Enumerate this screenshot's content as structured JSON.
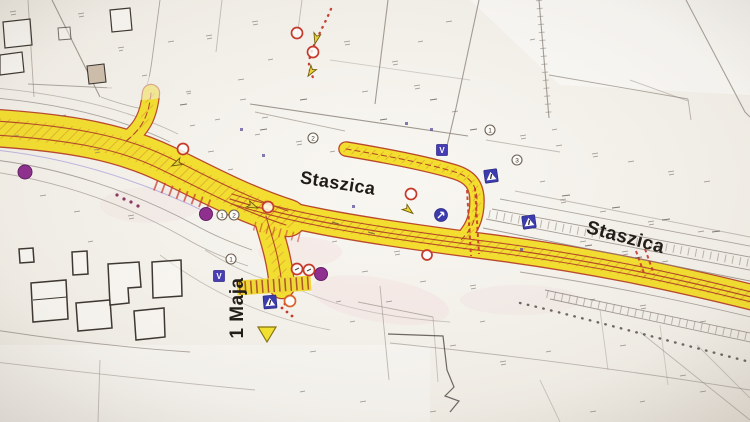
{
  "map": {
    "kind": "road-construction-plan-photo",
    "visible_street_names": [
      "Staszica",
      "Staszica",
      "1 Maja"
    ]
  },
  "labels": {
    "staszica_upper": "Staszica",
    "staszica_right": "Staszica",
    "maja": "1 Maja"
  },
  "markers": {
    "ref_circles": [
      {
        "label": "1"
      },
      {
        "label": "2"
      },
      {
        "label": "1"
      },
      {
        "label": "2"
      },
      {
        "label": "1"
      },
      {
        "label": "3"
      }
    ],
    "v_signs": [
      {
        "label": "V"
      },
      {
        "label": "V"
      }
    ]
  },
  "colors": {
    "paper": "#f2efe8",
    "road_highlight": "#f2de37",
    "road_edge": "#b5492e",
    "hatch_orange": "#d08a2c",
    "sign_blue": "#3a3aa8",
    "marker_purple": "#8b2f8b",
    "marking_red": "#c0392b",
    "linework": "#8d857c",
    "building_line": "#3c362f",
    "text": "#1f1a15"
  }
}
